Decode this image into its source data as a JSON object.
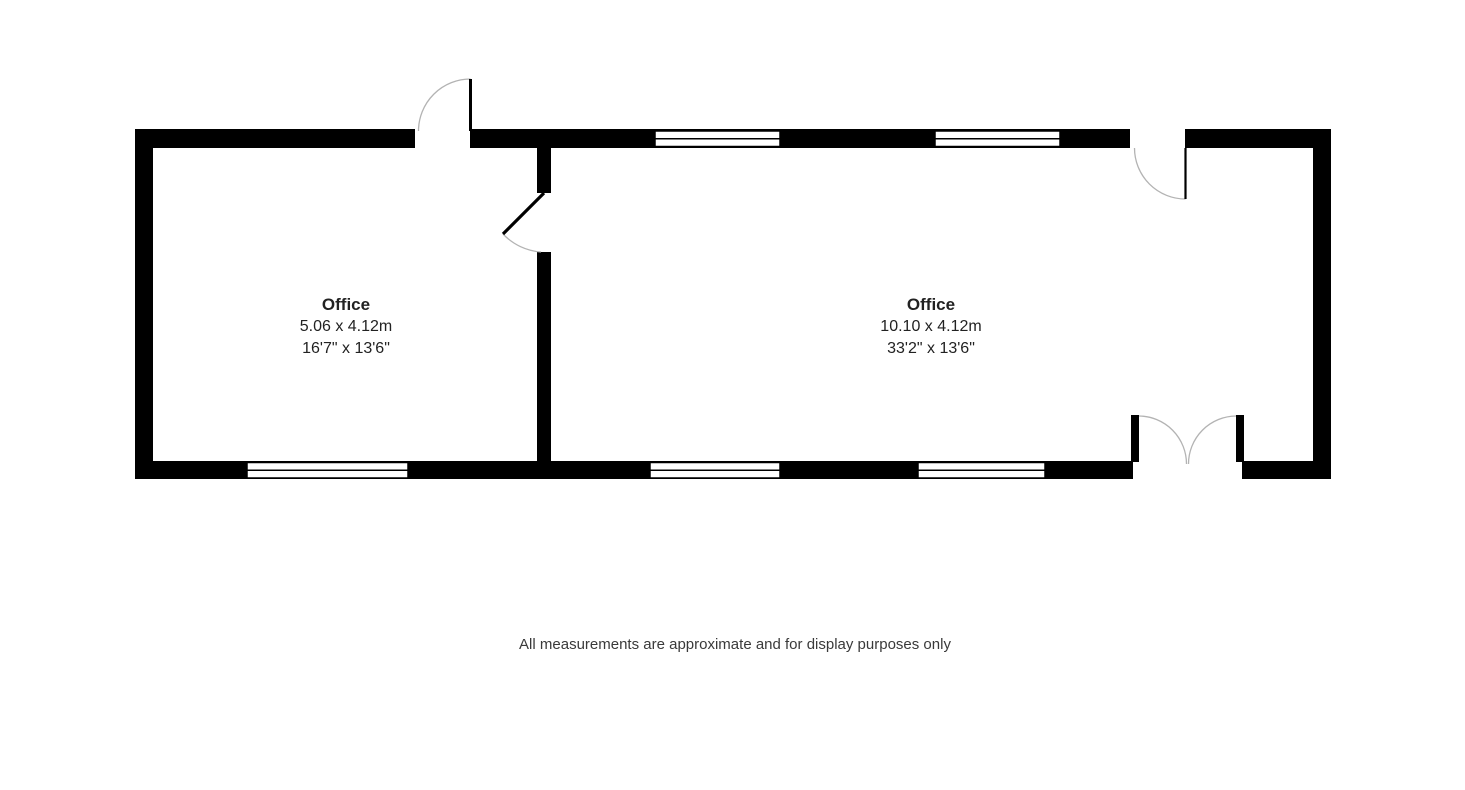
{
  "floorplan": {
    "rooms": [
      {
        "name": "Office",
        "metric": "5.06 x 4.12m",
        "imperial": "16'7\" x 13'6\""
      },
      {
        "name": "Office",
        "metric": "10.10 x 4.12m",
        "imperial": "33'2\" x 13'6\""
      }
    ],
    "disclaimer": "All measurements are approximate and for display purposes only"
  },
  "colors": {
    "wall": "#000000",
    "window_fill": "#ffffff",
    "door_arc": "#b3b3b3",
    "text": "#222222",
    "background": "#ffffff"
  }
}
